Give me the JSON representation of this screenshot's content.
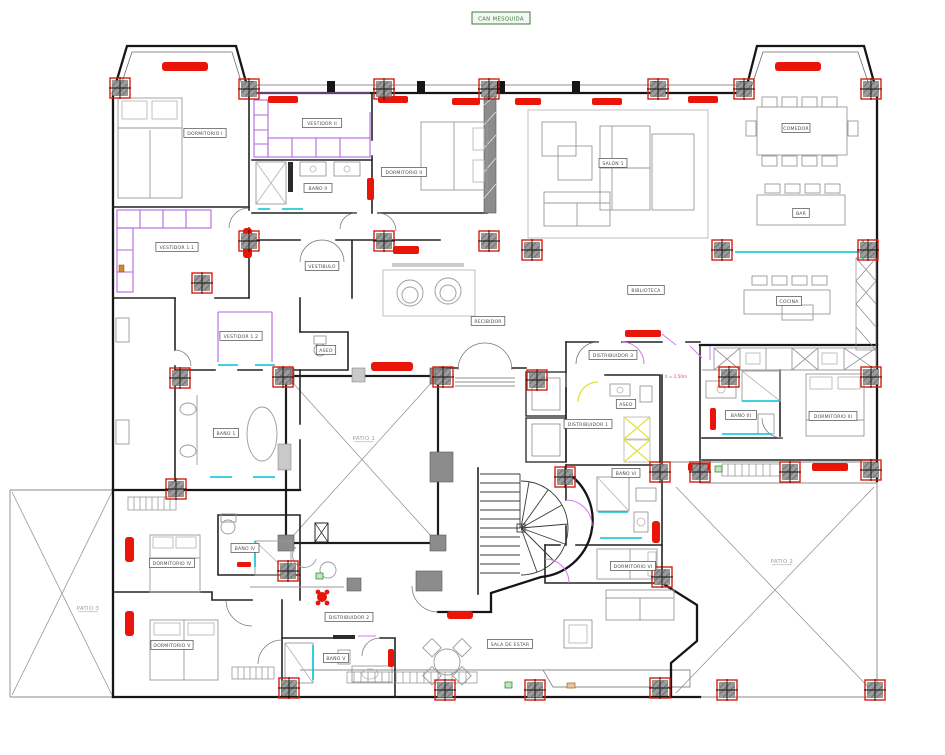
{
  "title": {
    "text": "CAN MESQUIDA"
  },
  "plan": {
    "room_labels": [
      {
        "text": "DORMITORIO I",
        "x": 205,
        "y": 133,
        "style": "boxed"
      },
      {
        "text": "VESTIDOR II",
        "x": 322,
        "y": 123,
        "style": "boxed"
      },
      {
        "text": "BAÑO II",
        "x": 318,
        "y": 188,
        "style": "boxed"
      },
      {
        "text": "DORMITORIO II",
        "x": 404,
        "y": 172,
        "style": "boxed"
      },
      {
        "text": "VESTIDOR 1.1",
        "x": 177,
        "y": 247,
        "style": "boxed"
      },
      {
        "text": "VESTIBULO",
        "x": 322,
        "y": 266,
        "style": "boxed"
      },
      {
        "text": "VESTIDOR 1.2",
        "x": 241,
        "y": 336,
        "style": "boxed"
      },
      {
        "text": "ASEO",
        "x": 326,
        "y": 350,
        "style": "boxed"
      },
      {
        "text": "BAÑO 1",
        "x": 226,
        "y": 433,
        "style": "boxed"
      },
      {
        "text": "RECIBIDOR",
        "x": 488,
        "y": 321,
        "style": "boxed"
      },
      {
        "text": "SALÓN 1",
        "x": 613,
        "y": 163,
        "style": "boxed"
      },
      {
        "text": "COMEDOR",
        "x": 796,
        "y": 128,
        "style": "boxed"
      },
      {
        "text": "BAR",
        "x": 801,
        "y": 213,
        "style": "boxed"
      },
      {
        "text": "BIBLIOTECA",
        "x": 646,
        "y": 290,
        "style": "boxed"
      },
      {
        "text": "COCINA",
        "x": 789,
        "y": 301,
        "style": "boxed"
      },
      {
        "text": "DISTRIBUIDOR 3",
        "x": 613,
        "y": 355,
        "style": "boxed"
      },
      {
        "text": "ASEO",
        "x": 626,
        "y": 404,
        "style": "boxed"
      },
      {
        "text": "DISTRIBUIDOR 1",
        "x": 588,
        "y": 424,
        "style": "boxed"
      },
      {
        "text": "BAÑO VI",
        "x": 626,
        "y": 473,
        "style": "boxed"
      },
      {
        "text": "BAÑO III",
        "x": 741,
        "y": 415,
        "style": "boxed"
      },
      {
        "text": "DORMITORIO III",
        "x": 833,
        "y": 416,
        "style": "boxed"
      },
      {
        "text": "DORMITORIO VI",
        "x": 633,
        "y": 566,
        "style": "boxed"
      },
      {
        "text": "SALA DE ESTAR",
        "x": 510,
        "y": 644,
        "style": "boxed"
      },
      {
        "text": "DISTRIBUIDOR 2",
        "x": 349,
        "y": 617,
        "style": "boxed"
      },
      {
        "text": "BAÑO IV",
        "x": 245,
        "y": 548,
        "style": "boxed"
      },
      {
        "text": "BAÑO V",
        "x": 336,
        "y": 658,
        "style": "boxed"
      },
      {
        "text": "DORMITORIO IV",
        "x": 172,
        "y": 563,
        "style": "boxed"
      },
      {
        "text": "DORMITORIO V",
        "x": 172,
        "y": 645,
        "style": "boxed"
      },
      {
        "text": "PATIO 1",
        "x": 364,
        "y": 438,
        "style": "plain"
      },
      {
        "text": "PATIO 2",
        "x": 782,
        "y": 561,
        "style": "plain"
      },
      {
        "text": "PATIO 3",
        "x": 88,
        "y": 608,
        "style": "plain"
      }
    ],
    "annotations": [
      {
        "text": "h = 2,50m",
        "x": 676,
        "y": 378
      }
    ],
    "colors": {
      "wall": "#161616",
      "furniture": "#9a9a9a",
      "radiator_red": "#ea1408",
      "plumbing_cyan": "#00c3d6",
      "wardrobe_purple": "#b465e0",
      "column_border_red": "#d22011",
      "elevator_yellow": "#e6e23a",
      "title_green": "#3f7a3f",
      "annotation_pink": "#e0457b"
    }
  }
}
